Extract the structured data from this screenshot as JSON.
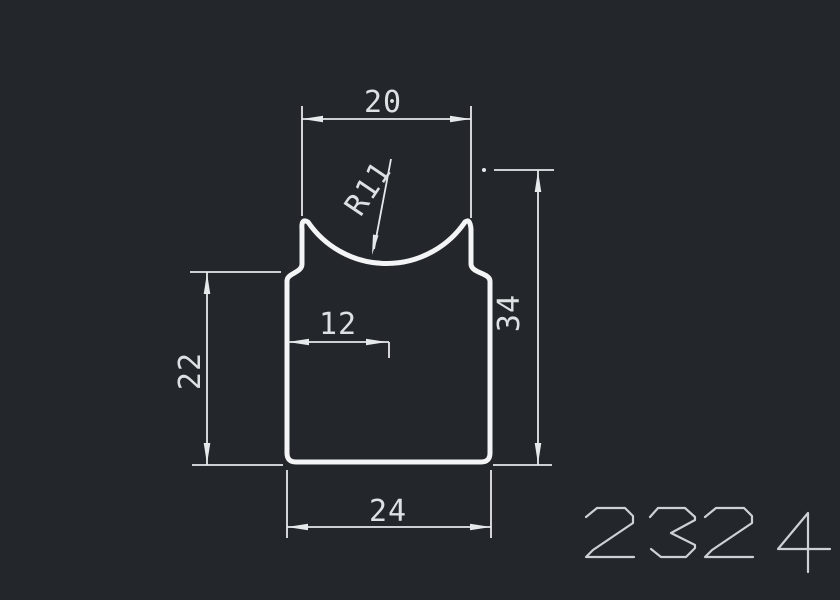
{
  "drawing": {
    "part_number": {
      "text": "2324"
    },
    "dimensions": {
      "top_width": {
        "label": "20",
        "value": 20
      },
      "radius": {
        "label": "R11",
        "value": 11
      },
      "left_height": {
        "label": "22",
        "value": 22
      },
      "inner_width": {
        "label": "12",
        "value": 12
      },
      "right_height": {
        "label": "34",
        "value": 34
      },
      "bottom_width": {
        "label": "24",
        "value": 24
      }
    },
    "colors": {
      "background": "#23262b",
      "outline": "#f2f4f6",
      "dimension_lines": "#e6e9eb",
      "dimension_text": "#dde1e4",
      "part_number_text": "#ccd1d5"
    }
  }
}
